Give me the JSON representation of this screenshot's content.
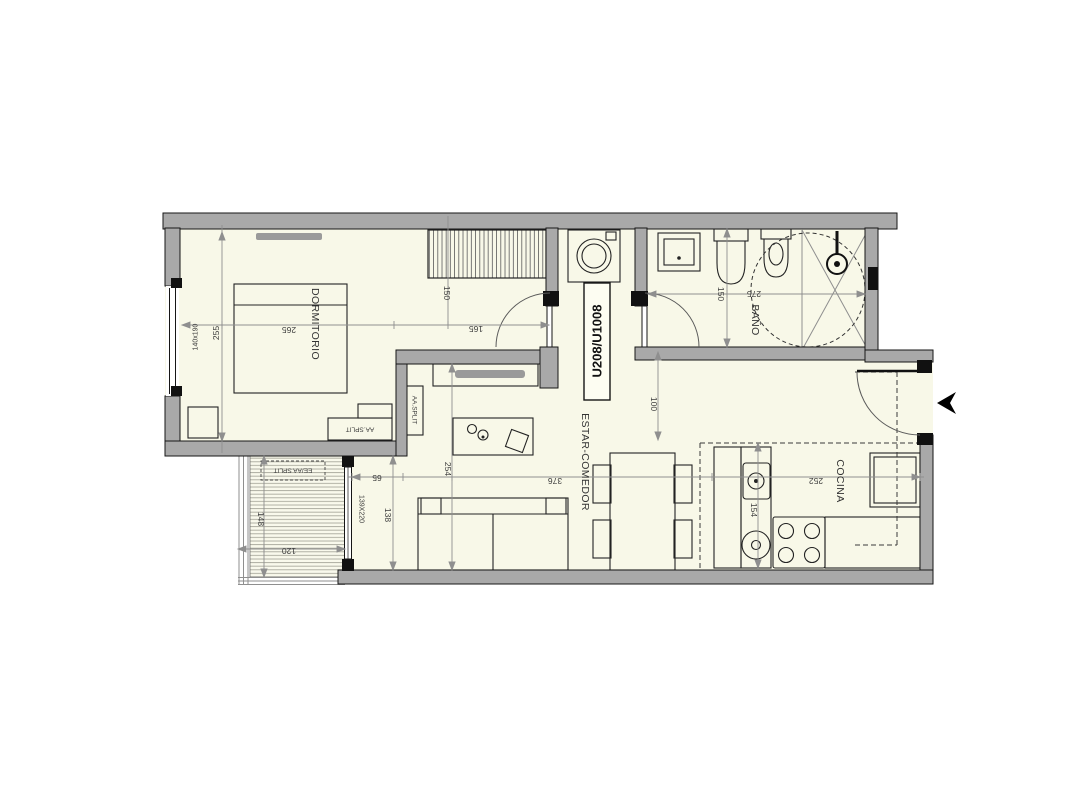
{
  "unit": {
    "label": "U208/U1008"
  },
  "rooms": {
    "bedroom": "DORMITORIO",
    "living_dining": "ESTAR-COMEDOR",
    "bathroom": "BAÑO",
    "kitchen": "COCINA"
  },
  "equipment": {
    "ac_indoor_bedroom": "AA.SPLIT",
    "ac_indoor_living": "AA.SPLIT",
    "ac_outdoor_balcony": "EE/AA SPLIT"
  },
  "dimensions_cm": {
    "bedroom_depth": "255",
    "bedroom_width": "265",
    "bedroom_width_right": "165",
    "bedroom_window": "140x190",
    "closet_width": "150",
    "bathroom_length": "275",
    "bathroom_width": "150",
    "hall_passage": "100",
    "living_depth": "254",
    "living_length": "376",
    "sofa_nook_offset": "65",
    "sofa_nook_depth": "138",
    "balcony_door": "139X220",
    "balcony_depth": "148",
    "balcony_width": "120",
    "kitchen_length": "252",
    "kitchen_depth": "154"
  },
  "icons": {
    "entrance_arrow": "black left-pointing entry arrow"
  },
  "colors": {
    "floor": "#f8f8e8",
    "wall": "#a9a9a9",
    "dimension_gray": "#8f8f8f"
  }
}
